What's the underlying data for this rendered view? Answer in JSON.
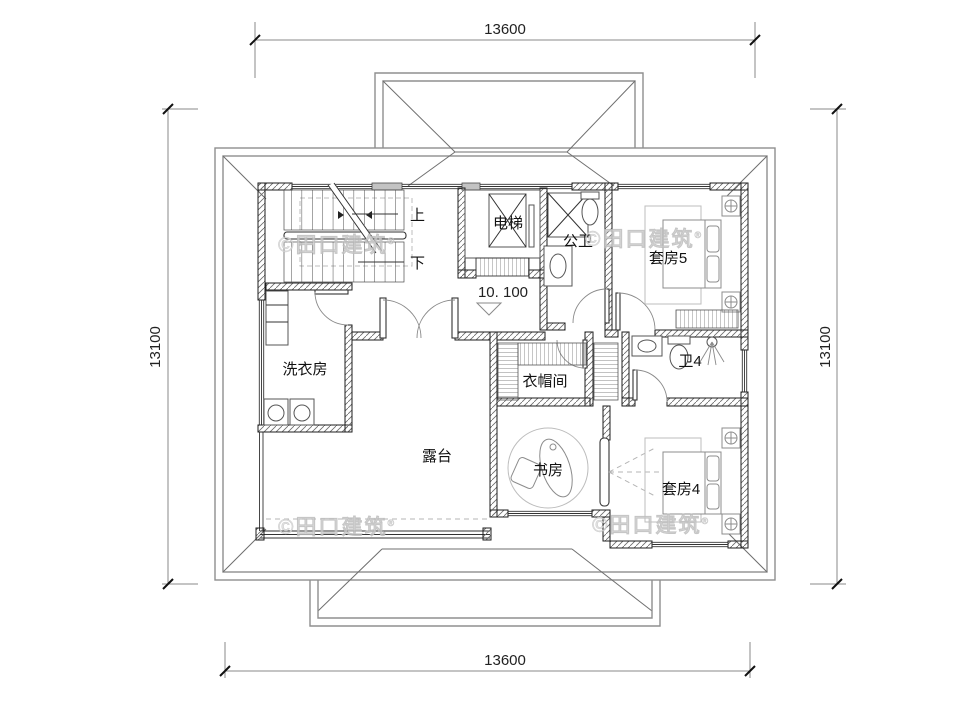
{
  "drawing": {
    "title": "second-floor-plan",
    "watermark": "©田口建筑",
    "watermark_reg": "®",
    "elevation_label": "10. 100",
    "dimensions": {
      "top": "13600",
      "bottom": "13600",
      "left": "13100",
      "right": "13100"
    },
    "rooms": {
      "stairs_up": "上",
      "stairs_down": "下",
      "elevator": "电梯",
      "public_bath": "公卫",
      "suite5": "套房5",
      "laundry": "洗衣房",
      "closet": "衣帽间",
      "bath4": "卫4",
      "terrace": "露台",
      "study": "书房",
      "suite4": "套房4"
    },
    "colors": {
      "wall_line": "#1c1c1c",
      "roof_line": "#8f8f8f",
      "watermark": "#dcdcdc",
      "background": "#ffffff"
    }
  }
}
